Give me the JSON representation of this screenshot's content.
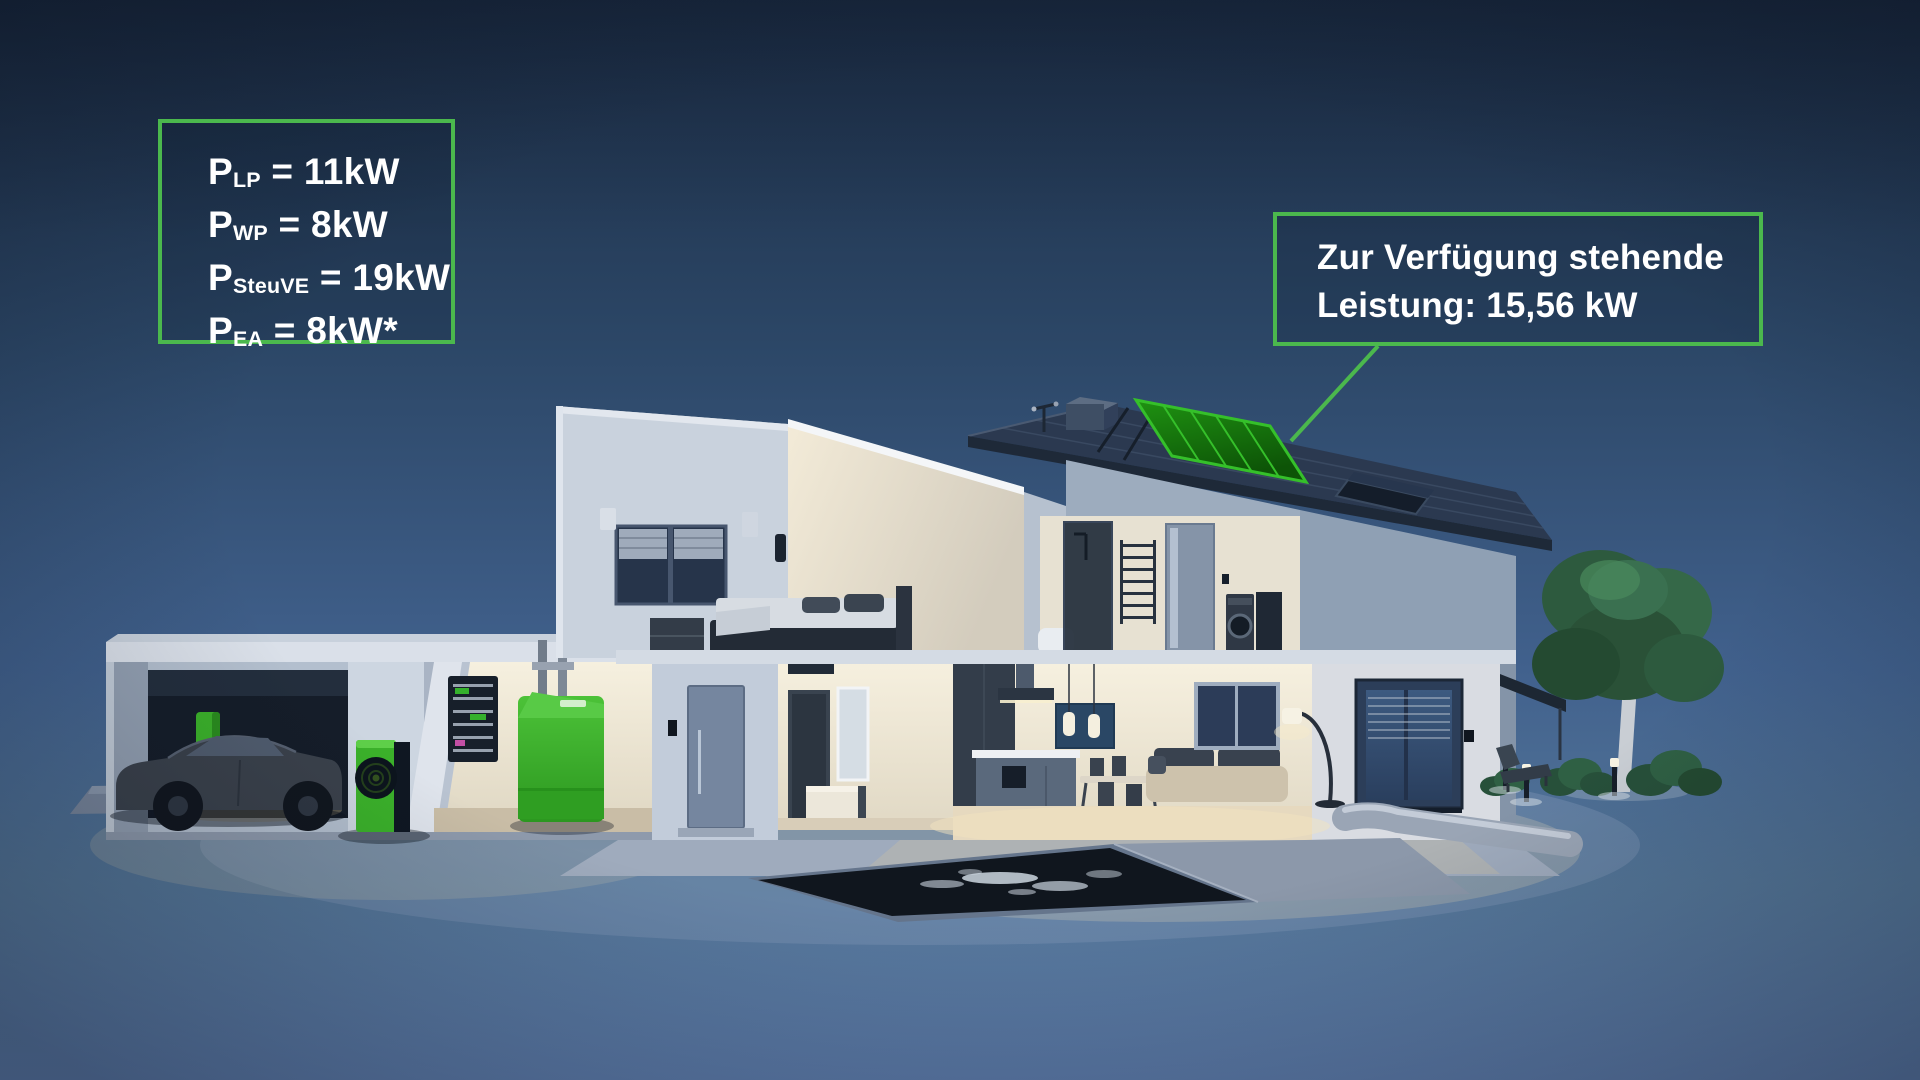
{
  "colors": {
    "accent_green": "#4bb84d",
    "equipment_green": "#3bb12a",
    "panel_green": "#1f9212",
    "panel_edge_green": "#35c02a",
    "sky_top": "#1b2c44",
    "sky_bottom": "#5e7dac",
    "text": "#ffffff"
  },
  "power_box": {
    "lines": [
      {
        "base": "P",
        "sub": "LP",
        "rest": " = 11kW"
      },
      {
        "base": "P",
        "sub": "WP",
        "rest": " = 8kW"
      },
      {
        "base": "P",
        "sub": "SteuVE",
        "rest": " = 19kW"
      },
      {
        "base": "P",
        "sub": "EA",
        "rest": " = 8kW*"
      }
    ]
  },
  "callout": {
    "line1": "Zur Verfügung stehende",
    "line2": "Leistung: 15,56 kW"
  }
}
